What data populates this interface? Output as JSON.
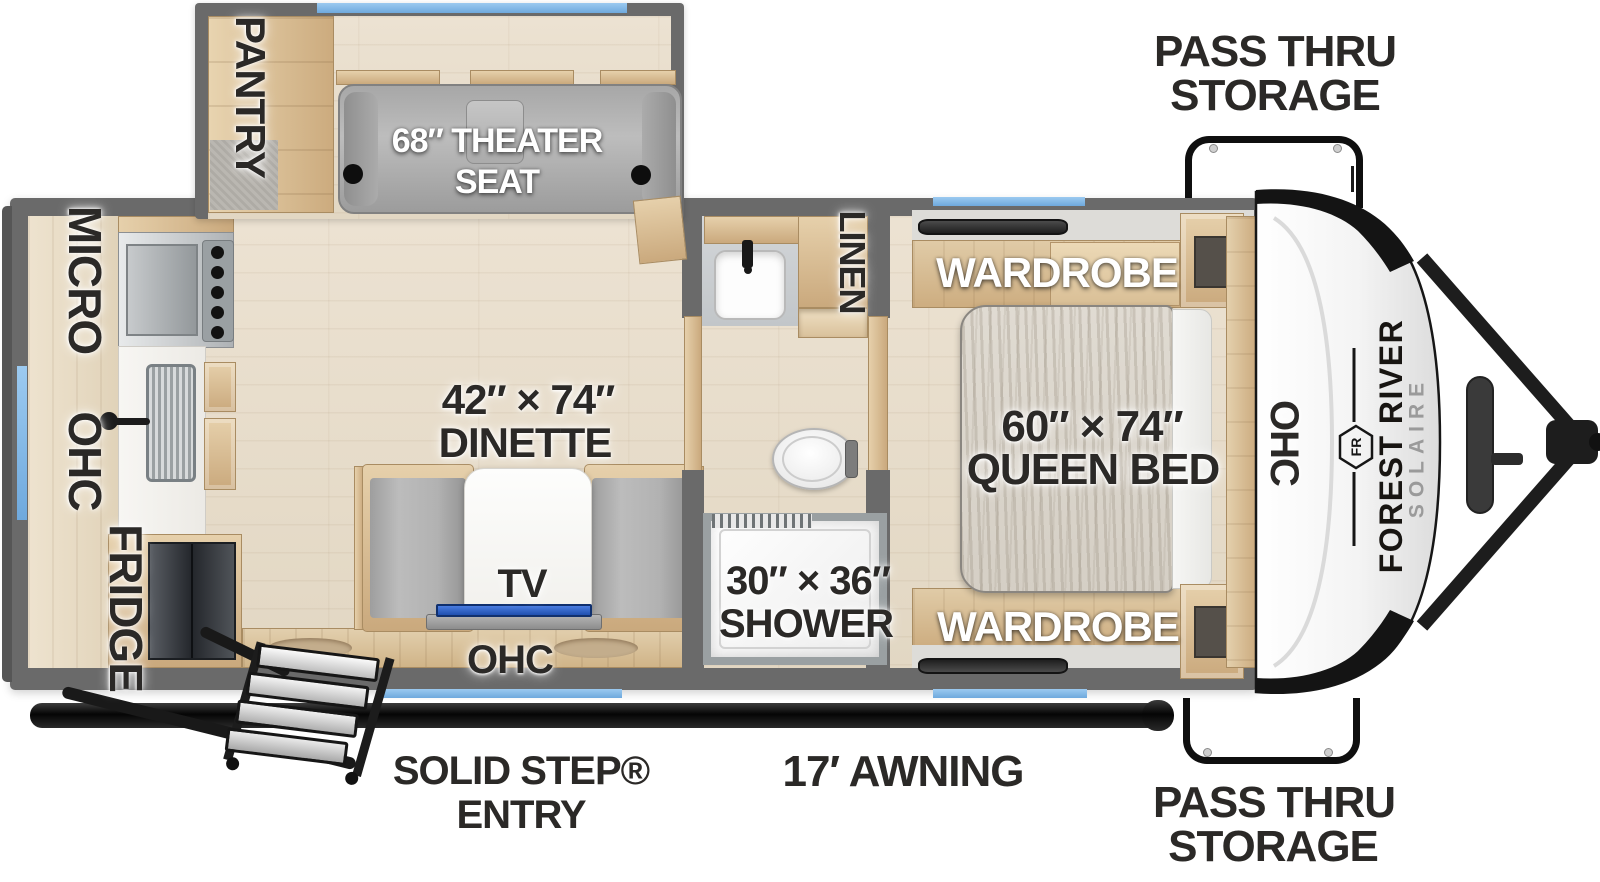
{
  "floorplan": {
    "storage": {
      "top": {
        "line1": "PASS THRU",
        "line2": "STORAGE"
      },
      "bottom": {
        "line1": "PASS THRU",
        "line2": "STORAGE"
      }
    },
    "slideout": {
      "pantry_label": "PANTRY",
      "theater_line1": "68″ THEATER",
      "theater_line2": "SEAT"
    },
    "kitchen": {
      "micro_label": "MICRO",
      "ohc_label": "OHC",
      "fridge_label": "FRIDGE"
    },
    "dinette": {
      "size_label": "42″ × 74″",
      "name_label": "DINETTE",
      "tv_label": "TV",
      "ohc_label": "OHC"
    },
    "bathroom": {
      "linen_label": "LINEN",
      "shower_size_label": "30″ × 36″",
      "shower_label": "SHOWER"
    },
    "bedroom": {
      "wardrobe_top_label": "WARDROBE",
      "bed_size_label": "60″ × 74″",
      "bed_label": "QUEEN BED",
      "wardrobe_bottom_label": "WARDROBE",
      "ohc_label": "OHC"
    },
    "front_cap": {
      "brand_line1": "FOREST RIVER",
      "brand_line2": "SOLAIRE",
      "logo_monogram": "FR"
    },
    "exterior": {
      "entry_line1": "SOLID STEP®",
      "entry_line2": "ENTRY",
      "awning_label": "17′ AWNING"
    },
    "colors": {
      "wall": "#6a6a6a",
      "floor": "#e8dfd0",
      "wood": "#d6bb93",
      "cushion": "#b3b3b3",
      "window_blue": "#7db7e8",
      "tv_blue": "#2e62c4",
      "label_dark": "#2b2927",
      "label_white": "#ffffff",
      "exterior_black": "#161616"
    }
  }
}
